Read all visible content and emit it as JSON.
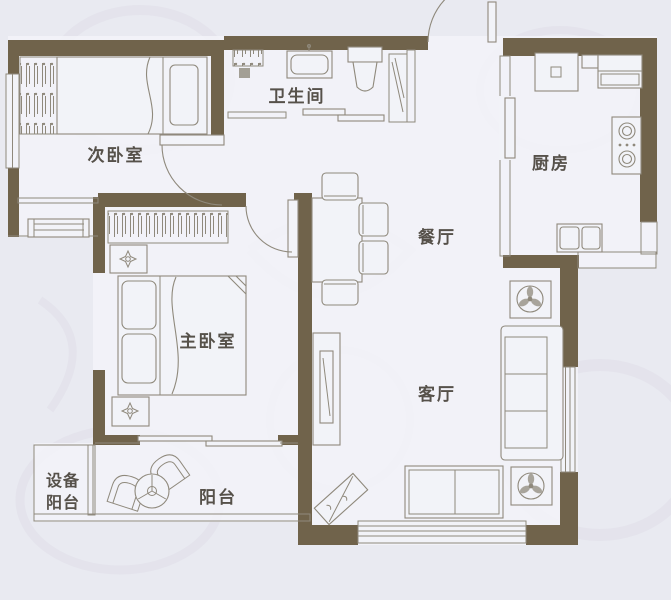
{
  "rooms": {
    "secondary_bedroom": {
      "label": "次卧室"
    },
    "bathroom": {
      "label": "卫生间"
    },
    "kitchen": {
      "label": "厨房"
    },
    "dining_room": {
      "label": "餐厅"
    },
    "master_bedroom": {
      "label": "主卧室"
    },
    "living_room": {
      "label": "客厅"
    },
    "balcony": {
      "label": "阳台"
    },
    "equipment_balcony": {
      "label": "设备阳台",
      "lines": [
        "设备",
        "阳台"
      ]
    }
  },
  "colors": {
    "wall": "#70634b",
    "line": "#8f897c",
    "floor": "#f2f3f8",
    "background": "#e9eaf1",
    "swirl": "#dedce7",
    "label": "#56514a"
  }
}
